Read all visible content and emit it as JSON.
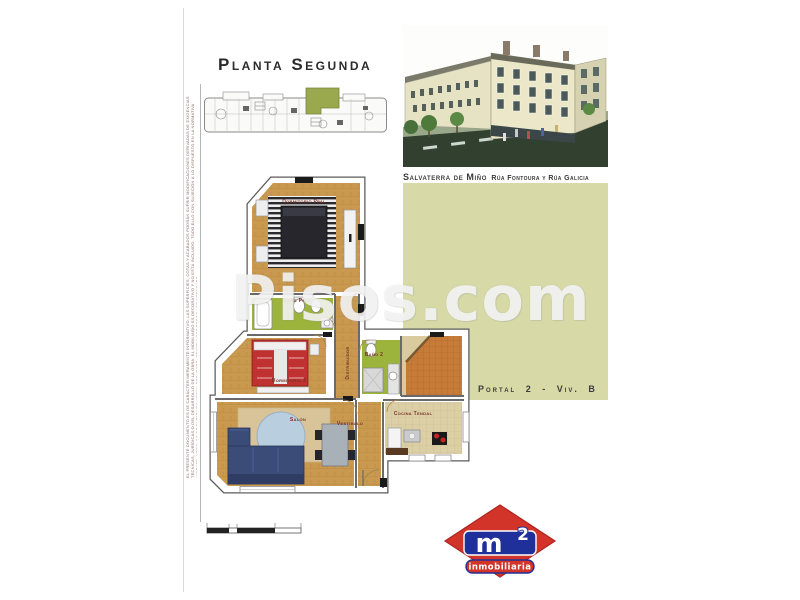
{
  "header": {
    "title": "Planta Segunda"
  },
  "project": {
    "name": "Salvaterra de Miño",
    "streets": "Rúa Fontoura y Rúa Galicia",
    "unit": "Portal 2 - Viv. B"
  },
  "watermark": "Pisos.com",
  "floorplan": {
    "rooms": {
      "master": "Dormitorio Ppal",
      "bath_main": "Baño Ppal",
      "bedroom2": "Dormitorio 2",
      "hall": "Distribuidor",
      "bath2": "Baño 2",
      "living": "Salón",
      "vestibule": "Vestíbulo",
      "kitchen": "Cocina Tendal"
    }
  },
  "legal": "EL PRESENTE DOCUMENTO ES DE CARÁCTER MERAMENTE INFORMATIVO. LAS SUPERFICIES, COTAS Y ACABADOS PODRÁN SUFRIR MODIFICACIONES DERIVADAS DE EXIGENCIAS TÉCNICAS, JURÍDICAS O DEL DESARROLLO DE LA OBRA. EL MOBILIARIO ES DECORATIVO Y NO ESTÁ INCLUIDO. TODO ELLO CON SUJECIÓN A LO DISPUESTO EN LA NORMATIVA VIGENTE. MODELOS ORIENTATIVOS SEGÚN PROYECTO. RESERVADOS TODOS LOS DERECHOS.",
  "logo": {
    "m": "m",
    "sup": "2",
    "tagline": "inmobiliaria"
  },
  "colors": {
    "panel": "#d7daa7",
    "wood_floor": "#c8994f",
    "bathroom_floor": "#9cb33c",
    "terrace_tile": "#c67c38",
    "keyplan_highlight": "#9aa84e",
    "logo_red": "#d2342a",
    "logo_blue": "#20309a",
    "label_red": "#7b3226"
  }
}
